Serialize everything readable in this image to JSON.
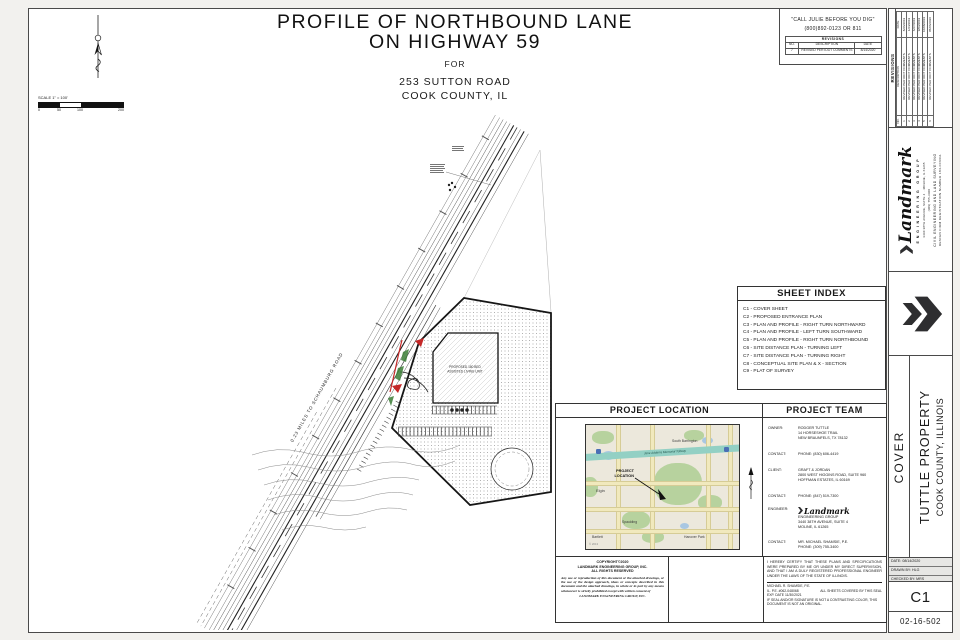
{
  "title": {
    "line1": "PROFILE OF NORTHBOUND LANE",
    "line2": "ON HIGHWAY 59",
    "line3": "FOR",
    "line4": "253 SUTTON ROAD",
    "line5": "COOK COUNTY, IL"
  },
  "call_note": {
    "line1": "\"CALL JULIE BEFORE YOU DIG\"",
    "line2": "(800)892-0123 OR 811"
  },
  "revisions_top": {
    "title": "REVISIONS",
    "headers": [
      "NO.",
      "DESCRIPTION",
      "DATE"
    ],
    "rows": [
      {
        "no": "7",
        "description": "REVISED PER IDOT COMMENTS",
        "date": "8/14/2020"
      }
    ]
  },
  "revisions_side": {
    "title": "REVISIONS",
    "headers": [
      "NO.",
      "DESCRIPTION",
      "DATE"
    ],
    "rows": [
      {
        "no": "1",
        "description": "REVISED PER IDOT COMMENTS",
        "date": "8/26/2019"
      },
      {
        "no": "2",
        "description": "REVISED PER IDOT COMMENTS",
        "date": "1/24/2019"
      },
      {
        "no": "3",
        "description": "REVISED PER IDOT COMMENTS",
        "date": "6/27/2019"
      },
      {
        "no": "4",
        "description": "REVISED PER IDOT COMMENTS",
        "date": "9/03/2019"
      },
      {
        "no": "5",
        "description": "REVISED PER IDOT COMMENTS",
        "date": "10/08/2019"
      },
      {
        "no": "6",
        "description": "REVISED PER IDOT COMMENTS",
        "date": "05/06/2020"
      }
    ]
  },
  "scale_bar": {
    "label": "SCALE 1\" = 100'",
    "ticks": [
      "0",
      "50",
      "100",
      "200"
    ]
  },
  "plan": {
    "road_distance_label": "0.23 MILES TO SCHAUMBURG ROAD",
    "building_label_line1": "PROPOSED 180 BED",
    "building_label_line2": "ASSISTED LIVING UNIT"
  },
  "sheet_index": {
    "title": "SHEET INDEX",
    "items": [
      "C1 - COVER SHEET",
      "C2 - PROPOSED ENTRANCE PLAN",
      "C3 - PLAN AND PROFILE - RIGHT TURN NORTHWARD",
      "C4 - PLAN AND PROFILE - LEFT TURN SOUTHWARD",
      "C5 - PLAN AND PROFILE - RIGHT TURN NORTHBOUND",
      "C6 - SITE DISTANCE PLAN - TURNING LEFT",
      "C7 - SITE DISTANCE PLAN - TURNING RIGHT",
      "C8 - CONCEPTUAL SITE PLAN & X - SECTION",
      "C9 - PLAT OF SURVEY"
    ]
  },
  "project_location": {
    "title": "PROJECT LOCATION",
    "map": {
      "label1": "PROJECT",
      "label2": "LOCATION",
      "tollway": "Jane Addams Memorial Tollway",
      "towns": [
        "South Barrington",
        "Elgin",
        "Spaulding",
        "Bartlett",
        "Hanover Park"
      ],
      "copyright": "© 2013"
    }
  },
  "project_team": {
    "title": "PROJECT TEAM",
    "rows": [
      {
        "label": "OWNER:",
        "lines": [
          "RODGER TUTTLE",
          "14 HORSESHOE TRAIL",
          "NEW BRAUNFELS, TX 78132"
        ]
      },
      {
        "label": "CONTACT:",
        "lines": [
          "PHONE: (830) 606-4419"
        ]
      },
      {
        "label": "CLIENT:",
        "lines": [
          "GRAFT & JORDAN",
          "2800 WEST HIGGINS ROAD, SUITE 960",
          "HOFFMAN ESTATES, IL 60169"
        ]
      },
      {
        "label": "CONTACT:",
        "lines": [
          "PHONE: (847) 519-7300"
        ]
      },
      {
        "label": "ENGINEER:",
        "lines": [
          "3440 38TH AVENUE, SUITE 4",
          "MOLINE, IL 61265"
        ]
      },
      {
        "label": "CONTACT:",
        "lines": [
          "MR. MICHAEL SHAMSIE, P.E.",
          "PHONE: (309) 755-3400"
        ]
      }
    ]
  },
  "certification": {
    "paragraph": "I HEREBY CERTIFY THAT THESE PLANS AND SPECIFICATIONS WERE PREPARED BY ME OR UNDER MY DIRECT SUPERVISION, AND THAT I AM A DULY REGISTERED PROFESSIONAL ENGINEER UNDER THE LAWS OF THE STATE OF ILLINOIS.",
    "name": "MICHAEL R. SHAMSIE, P.E.",
    "license": "IL. P.E. #062-048068",
    "seal_note": "ALL SHEETS COVERED BY THIS SEAL",
    "expiration": "EXP. DATE 11/30/2021",
    "disclaimer": "IF SEAL AND/OR SIGNATURE IS NOT A CONTRASTING COLOR, THIS DOCUMENT IS NOT AN ORIGINAL."
  },
  "copyright_block": {
    "line1": "COPYRIGHT©2020",
    "line2": "LANDMARK ENGINEERING GROUP, INC.",
    "line3": "ALL RIGHTS RESERVED",
    "paragraph": "Any use or reproduction of this document or the attached drawings, or the use of the design approach, ideas or concepts described in this document and the attached drawings, in whole or in part by any means whatsoever is strictly prohibited except with written consent of",
    "company": "LANDMARK ENGINEERING GROUP, INC."
  },
  "firm": {
    "name": "Landmark",
    "subtitle": "ENGINEERING GROUP",
    "address1": "3440 38TH AVENUE, SUITE 4",
    "address2": "MOLINE, IL 61265",
    "phone": "(309) 755-3400",
    "services": "CIVIL ENGINEERING AND LAND SURVEYING",
    "registration": "DESIGN FIRM REGISTRATION NUMBER 184-003311"
  },
  "titleblock": {
    "sheet_title": "COVER",
    "project": "TUTTLE PROPERTY",
    "location": "COOK COUNTY, ILLINOIS",
    "date": "DATE: 08/14/2020",
    "drawn": "DRAWN BY: HLG",
    "checked": "CHECKED BY: MRS",
    "sheet_no": "C1",
    "project_no": "02-16-502"
  },
  "colors": {
    "accent_red": "#c42828",
    "accent_green": "#3a7d36",
    "map_green": "#b7d29e",
    "map_toll_teal": "#93d0c4",
    "chevron_dark": "#2e2e30"
  }
}
